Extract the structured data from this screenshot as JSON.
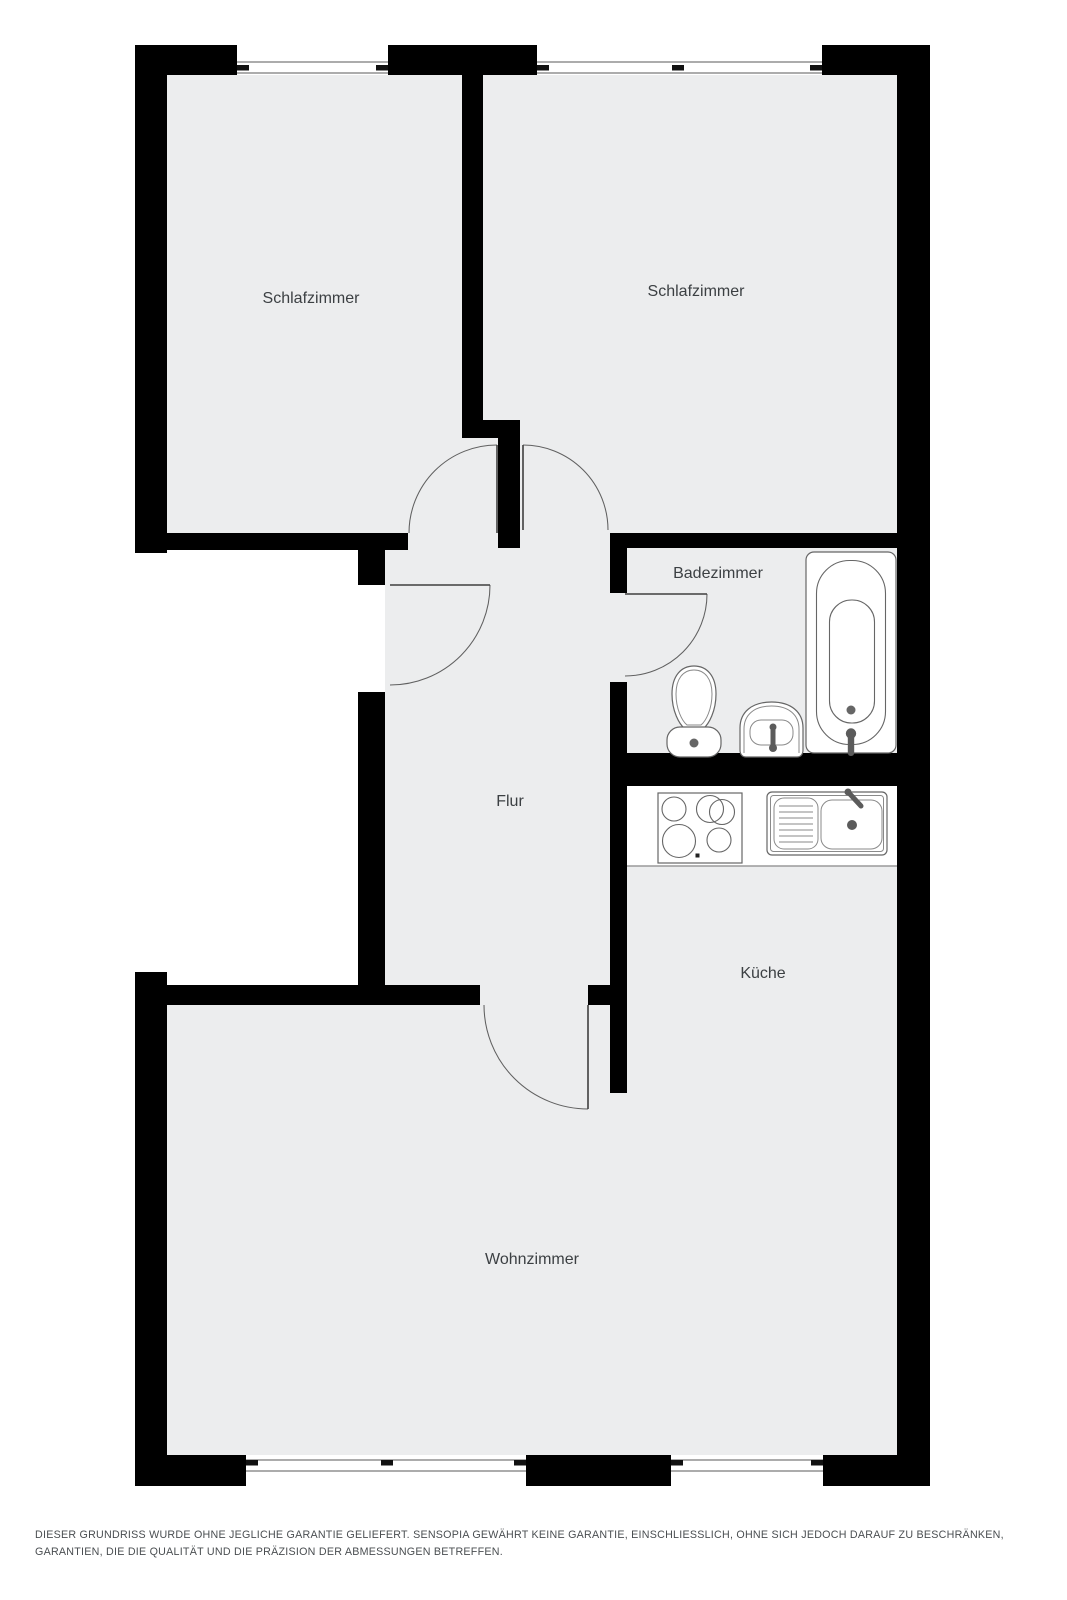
{
  "floorplan": {
    "rooms": [
      {
        "id": "schlafzimmer-1",
        "label": "Schlafzimmer"
      },
      {
        "id": "schlafzimmer-2",
        "label": "Schlafzimmer"
      },
      {
        "id": "badezimmer",
        "label": "Badezimmer"
      },
      {
        "id": "flur",
        "label": "Flur"
      },
      {
        "id": "kueche",
        "label": "Küche"
      },
      {
        "id": "wohnzimmer",
        "label": "Wohnzimmer"
      }
    ],
    "fixtures": [
      "bathtub",
      "toilet",
      "washbasin",
      "stove",
      "kitchen-sink"
    ],
    "window_symbols": 4,
    "door_symbols": 5,
    "colors": {
      "wall": "#000000",
      "floor": "#ECEDEE",
      "outline": "#666666",
      "label": "#3C4043",
      "disclaimer": "#4A4E51",
      "page": "#ffffff"
    }
  },
  "footer": {
    "disclaimer": "DIESER GRUNDRISS WURDE OHNE JEGLICHE GARANTIE GELIEFERT. SENSOPIA GEWÄHRT KEINE GARANTIE, EINSCHLIESSLICH, OHNE SICH JEDOCH DARAUF ZU BESCHRÄNKEN, GARANTIEN, DIE DIE QUALITÄT UND DIE PRÄZISION DER ABMESSUNGEN BETREFFEN."
  }
}
